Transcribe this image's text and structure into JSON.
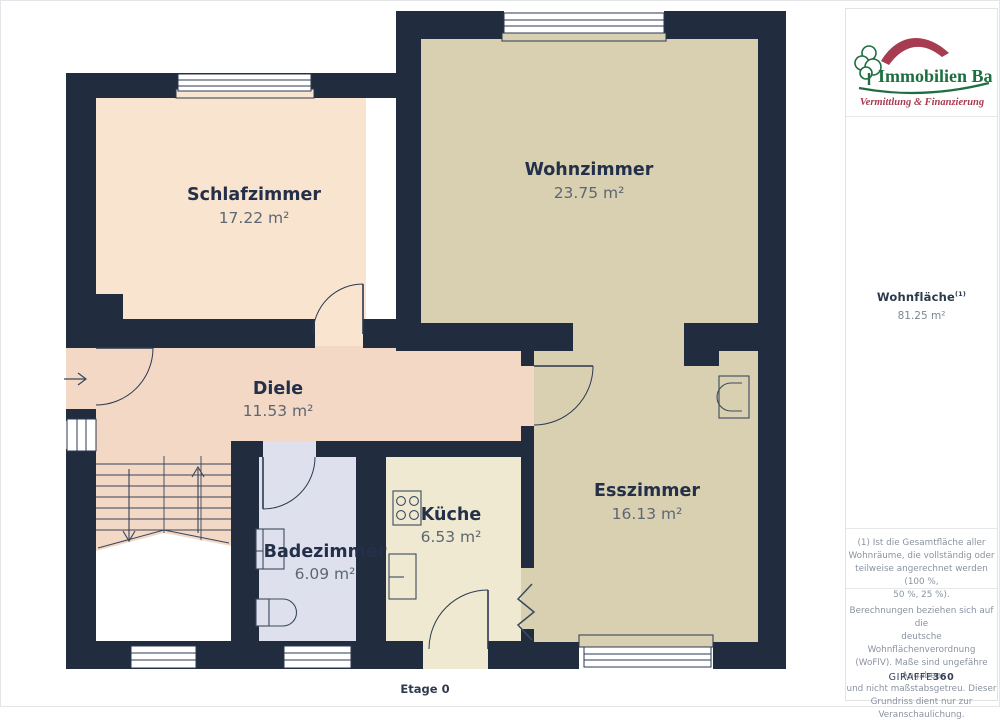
{
  "meta": {
    "floor_label": "Etage 0"
  },
  "colors": {
    "wall": "#212c3f",
    "room_schlafzimmer": "#f9e5cf",
    "room_wohnzimmer": "#d9d0b2",
    "room_diele": "#f2d8c5",
    "room_badezimmer": "#dee1ed",
    "room_kueche": "#f0e9d2",
    "room_esszimmer": "#d9d0b2",
    "logo_green": "#1d6e41",
    "logo_red": "#a73b50"
  },
  "rooms": [
    {
      "id": "schlafzimmer",
      "name": "Schlafzimmer",
      "area": "17.22 m²"
    },
    {
      "id": "wohnzimmer",
      "name": "Wohnzimmer",
      "area": "23.75 m²"
    },
    {
      "id": "diele",
      "name": "Diele",
      "area": "11.53 m²"
    },
    {
      "id": "badezimmer",
      "name": "Badezimmer",
      "area": "6.09 m²"
    },
    {
      "id": "kueche",
      "name": "Küche",
      "area": "6.53 m²"
    },
    {
      "id": "esszimmer",
      "name": "Esszimmer",
      "area": "16.13 m²"
    }
  ],
  "sidebar": {
    "logo": {
      "title": "Immobilien Bart",
      "subtitle": "Vermittlung & Finanzierung"
    },
    "living_area": {
      "label": "Wohnfläche",
      "superscript": "(1)",
      "value": "81.25 m²"
    },
    "footnote_lines": [
      "(1) Ist die Gesamtfläche aller",
      "Wohnräume, die vollständig oder",
      "teilweise angerechnet werden (100 %,",
      "50 %, 25 %)."
    ],
    "disclaimer_lines": [
      "Berechnungen beziehen sich auf die",
      "deutsche Wohnflächenverordnung",
      "(WoFlV). Maße sind ungefähre Angaben",
      "und nicht maßstabsgetreu. Dieser",
      "Grundriss dient nur zur",
      "Veranschaulichung."
    ],
    "brand": {
      "name": "GIRAFFE",
      "suffix": "360"
    }
  }
}
